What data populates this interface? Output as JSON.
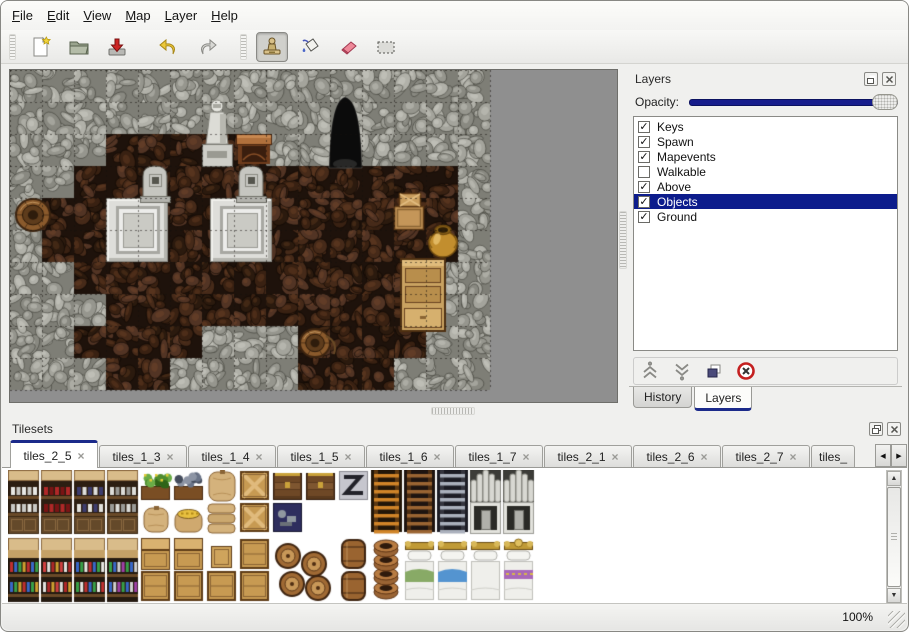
{
  "window": {
    "background": "#f0f0ee",
    "border_color": "#888884"
  },
  "menu_bar": {
    "items": [
      {
        "label": "File"
      },
      {
        "label": "Edit"
      },
      {
        "label": "View"
      },
      {
        "label": "Map"
      },
      {
        "label": "Layer"
      },
      {
        "label": "Help"
      }
    ]
  },
  "toolbar": {
    "buttons": [
      {
        "name": "new",
        "icon": "new-file-icon",
        "selected": false
      },
      {
        "name": "open",
        "icon": "open-folder-icon",
        "selected": false
      },
      {
        "name": "save",
        "icon": "save-icon",
        "selected": false
      },
      {
        "name": "undo",
        "icon": "undo-arrow-icon",
        "selected": false
      },
      {
        "name": "redo",
        "icon": "redo-arrow-icon",
        "selected": false
      },
      {
        "name": "stamp-tool",
        "icon": "stamp-tool-icon",
        "selected": true
      },
      {
        "name": "fill-tool",
        "icon": "fill-bucket-icon",
        "selected": false
      },
      {
        "name": "eraser-tool",
        "icon": "eraser-icon",
        "selected": false
      },
      {
        "name": "rect-select-tool",
        "icon": "rect-select-icon",
        "selected": false
      }
    ]
  },
  "map_view": {
    "tile_size": 32,
    "grid": [
      "WWWWWWWWWWWWWWW",
      "WWWWWWWWWWWWWWW",
      "WWWFFFFFWWWWWWW",
      "WWFFFFFFFFFFFFW",
      "WFFFFFFFFFFFFFW",
      "WFFFFFFFFFFFFFW",
      "WWFFFFFFFFFFFWW",
      "WWWFFFFFFFFFFWW",
      "WWFFFFWWWFFFFWW",
      "WWWFFWWWWFFFWWW"
    ],
    "objects": [
      {
        "type": "platform",
        "x": 96,
        "y": 128
      },
      {
        "type": "platform",
        "x": 200,
        "y": 128
      },
      {
        "type": "grave",
        "x": 128,
        "y": 94
      },
      {
        "type": "grave",
        "x": 224,
        "y": 94
      },
      {
        "type": "statue",
        "x": 188,
        "y": 28
      },
      {
        "type": "table",
        "x": 226,
        "y": 60
      },
      {
        "type": "cave",
        "x": 318,
        "y": 26
      },
      {
        "type": "crates",
        "x": 382,
        "y": 122
      },
      {
        "type": "goldpot",
        "x": 416,
        "y": 152
      },
      {
        "type": "cabinet",
        "x": 390,
        "y": 188
      },
      {
        "type": "barrel",
        "x": 6,
        "y": 128
      },
      {
        "type": "bucket",
        "x": 290,
        "y": 258
      }
    ],
    "palette": {
      "backdrop": "#8f8f8f",
      "wall": {
        "base": "#7e7e76",
        "tones": [
          "#b1b1a9",
          "#a4a49c",
          "#96968e",
          "#898981"
        ],
        "line": "rgba(55,55,48,0.55)",
        "hi": "rgba(215,215,205,0.35)"
      },
      "floor": {
        "base": "#1e120b",
        "tones": [
          "#462a19",
          "#392112",
          "#523424",
          "#2b1a0e"
        ],
        "line": "rgba(12,7,4,0.6)",
        "hi": "rgba(150,90,50,0.22)"
      },
      "grid_line": "rgba(20,16,12,0.5)"
    }
  },
  "layers_panel": {
    "title": "Layers",
    "opacity_label": "Opacity:",
    "opacity_percent": 100,
    "layers": [
      {
        "label": "Keys",
        "checked": true,
        "mark": "✓",
        "selected": false
      },
      {
        "label": "Spawn",
        "checked": true,
        "mark": "✓",
        "selected": false
      },
      {
        "label": "Mapevents",
        "checked": true,
        "mark": "✓",
        "selected": false
      },
      {
        "label": "Walkable",
        "checked": false,
        "mark": "",
        "selected": false
      },
      {
        "label": "Above",
        "checked": true,
        "mark": "✓",
        "selected": false
      },
      {
        "label": "Objects",
        "checked": true,
        "mark": "✓",
        "selected": true
      },
      {
        "label": "Ground",
        "checked": true,
        "mark": "✓",
        "selected": false
      }
    ],
    "buttons": [
      {
        "name": "raise-layer",
        "icon": "chevrons-up-icon"
      },
      {
        "name": "lower-layer",
        "icon": "chevrons-down-icon"
      },
      {
        "name": "duplicate-layer",
        "icon": "duplicate-icon"
      },
      {
        "name": "delete-layer",
        "icon": "delete-icon"
      }
    ],
    "tabs": [
      {
        "label": "History",
        "active": false
      },
      {
        "label": "Layers",
        "active": true
      }
    ]
  },
  "tilesets_panel": {
    "title": "Tilesets",
    "close_glyph": "×",
    "scroll_left_glyph": "◀",
    "scroll_right_glyph": "▶",
    "scrollbar": {
      "up_glyph": "▲",
      "down_glyph": "▼"
    },
    "tabs": [
      {
        "label": "tiles_2_5",
        "active": true,
        "truncated": false
      },
      {
        "label": "tiles_1_3",
        "active": false,
        "truncated": false
      },
      {
        "label": "tiles_1_4",
        "active": false,
        "truncated": false
      },
      {
        "label": "tiles_1_5",
        "active": false,
        "truncated": false
      },
      {
        "label": "tiles_1_6",
        "active": false,
        "truncated": false
      },
      {
        "label": "tiles_1_7",
        "active": false,
        "truncated": false
      },
      {
        "label": "tiles_2_1",
        "active": false,
        "truncated": false
      },
      {
        "label": "tiles_2_6",
        "active": false,
        "truncated": false
      },
      {
        "label": "tiles_2_7",
        "active": false,
        "truncated": false
      },
      {
        "label": "tiles_",
        "active": false,
        "truncated": true
      }
    ],
    "items": [
      {
        "t": "shelf",
        "x": 0,
        "y": 0,
        "v": 0
      },
      {
        "t": "shelf",
        "x": 33,
        "y": 0,
        "v": 1
      },
      {
        "t": "shelf",
        "x": 66,
        "y": 0,
        "v": 2
      },
      {
        "t": "shelf",
        "x": 99,
        "y": 0,
        "v": 3
      },
      {
        "t": "planter",
        "x": 132,
        "y": 0,
        "v": 0
      },
      {
        "t": "sack",
        "x": 132,
        "y": 32,
        "v": 0
      },
      {
        "t": "planter",
        "x": 165,
        "y": 0,
        "v": 1
      },
      {
        "t": "sackopen",
        "x": 165,
        "y": 32,
        "v": 0
      },
      {
        "t": "sackbig",
        "x": 198,
        "y": 0,
        "v": 0
      },
      {
        "t": "sackpile",
        "x": 198,
        "y": 32,
        "v": 0
      },
      {
        "t": "cratex",
        "x": 231,
        "y": 0,
        "v": 0
      },
      {
        "t": "cratex",
        "x": 231,
        "y": 32,
        "v": 0
      },
      {
        "t": "chest",
        "x": 264,
        "y": 0,
        "v": 0
      },
      {
        "t": "cratedark",
        "x": 264,
        "y": 32,
        "v": 0
      },
      {
        "t": "chest",
        "x": 297,
        "y": 0,
        "v": 0
      },
      {
        "t": "logo",
        "x": 330,
        "y": 0,
        "v": 0
      },
      {
        "t": "ladder",
        "x": 363,
        "y": 0,
        "v": 0
      },
      {
        "t": "ladder",
        "x": 396,
        "y": 0,
        "v": 1
      },
      {
        "t": "ladder",
        "x": 429,
        "y": 0,
        "v": 2
      },
      {
        "t": "cavearch",
        "x": 462,
        "y": 0,
        "v": 0
      },
      {
        "t": "cavedoor",
        "x": 462,
        "y": 32,
        "v": 0
      },
      {
        "t": "cavearch",
        "x": 495,
        "y": 0,
        "v": 0
      },
      {
        "t": "cavedoor",
        "x": 495,
        "y": 32,
        "v": 0
      },
      {
        "t": "shelfb",
        "x": 0,
        "y": 68,
        "v": 0
      },
      {
        "t": "shelfb",
        "x": 33,
        "y": 68,
        "v": 1
      },
      {
        "t": "shelfb",
        "x": 66,
        "y": 68,
        "v": 2
      },
      {
        "t": "shelfb",
        "x": 99,
        "y": 68,
        "v": 3
      },
      {
        "t": "cratelid",
        "x": 132,
        "y": 68,
        "v": 0
      },
      {
        "t": "crateplain",
        "x": 132,
        "y": 100,
        "v": 0
      },
      {
        "t": "cratelid",
        "x": 165,
        "y": 68,
        "v": 0
      },
      {
        "t": "crateplain",
        "x": 165,
        "y": 100,
        "v": 0
      },
      {
        "t": "cratesmall",
        "x": 198,
        "y": 68,
        "v": 0
      },
      {
        "t": "crateplain",
        "x": 198,
        "y": 100,
        "v": 0
      },
      {
        "t": "crateplain",
        "x": 231,
        "y": 68,
        "v": 0
      },
      {
        "t": "crateplain",
        "x": 231,
        "y": 100,
        "v": 0
      },
      {
        "t": "barrelpile",
        "x": 264,
        "y": 68,
        "v": 0
      },
      {
        "t": "barrelup",
        "x": 330,
        "y": 68,
        "v": 0
      },
      {
        "t": "barrelup",
        "x": 330,
        "y": 100,
        "v": 0
      },
      {
        "t": "potstack",
        "x": 363,
        "y": 68,
        "v": 0
      },
      {
        "t": "bed",
        "x": 396,
        "y": 68,
        "v": 0
      },
      {
        "t": "bed",
        "x": 429,
        "y": 68,
        "v": 1
      },
      {
        "t": "bed",
        "x": 462,
        "y": 68,
        "v": 2
      },
      {
        "t": "bed",
        "x": 495,
        "y": 68,
        "v": 3
      }
    ]
  },
  "status_bar": {
    "zoom_level": "100%"
  }
}
